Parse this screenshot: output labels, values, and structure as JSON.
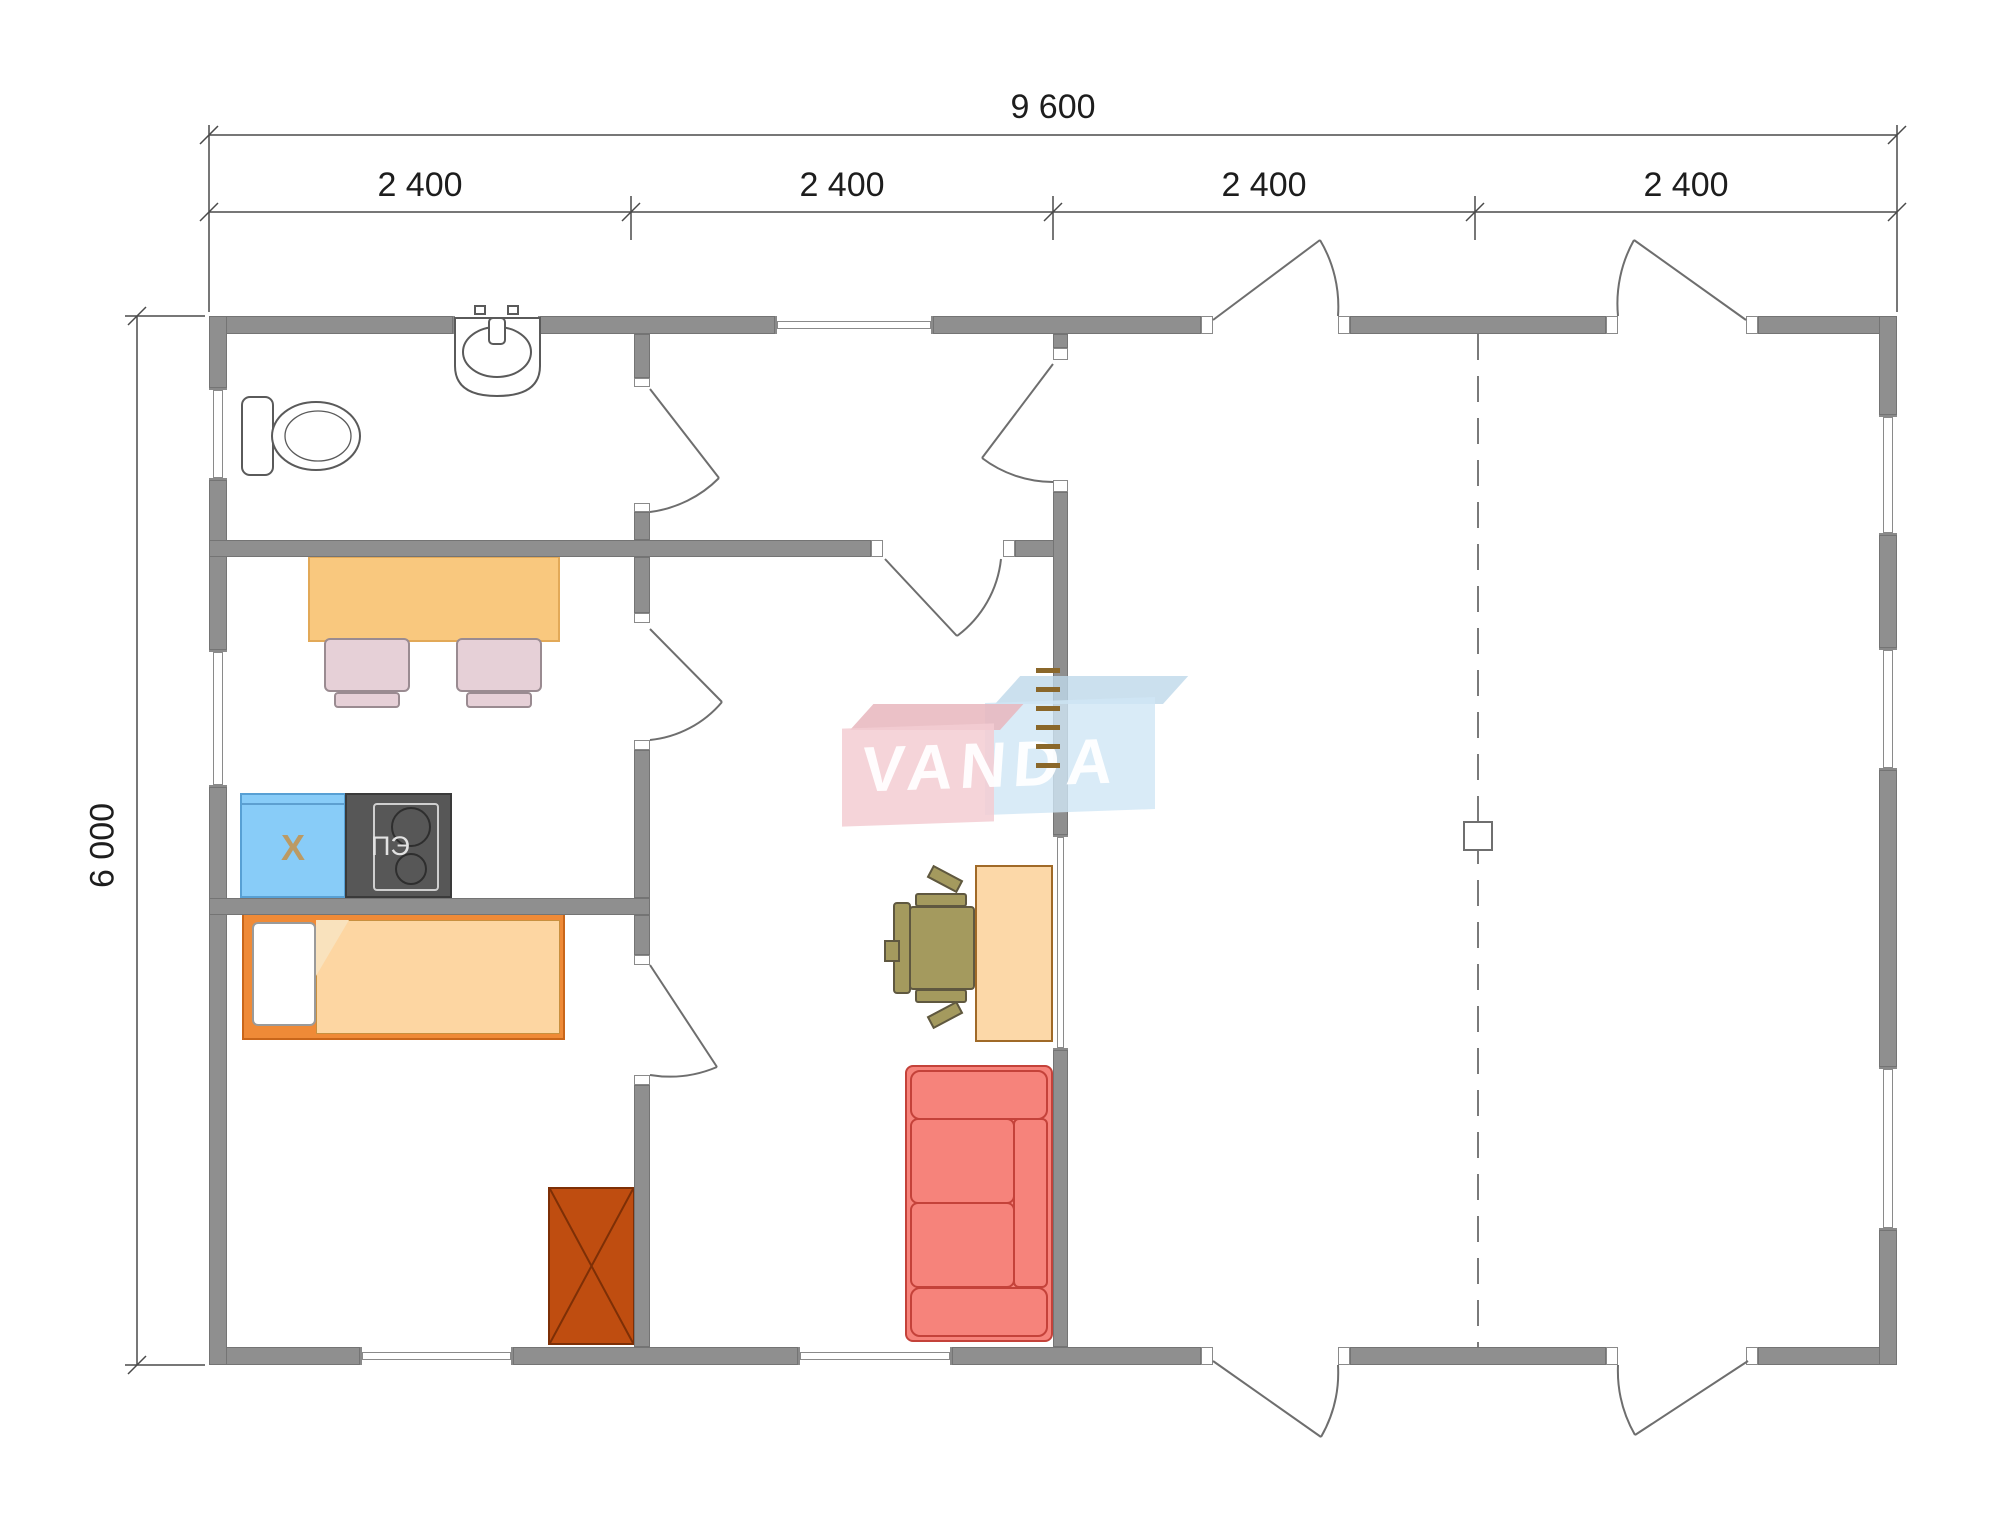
{
  "dimension_labels": {
    "overall_width": "9 600",
    "overall_height": "6 000",
    "modules": [
      "2 400",
      "2 400",
      "2 400",
      "2 400"
    ]
  },
  "appliance_labels": {
    "refrigerator": "X",
    "electric_stove": "ПЭ"
  },
  "watermark": {
    "text": "VANDA",
    "pink_color": "#f3cdd2",
    "blue_color": "#cfe6f5"
  },
  "colors": {
    "wall": "#8f8f8f",
    "dining_table": "#f9c87e",
    "kitchen_chair": "#e6d0d7",
    "refrigerator": "#88ccf8",
    "stove": "#575757",
    "bed_frame": "#ef8a37",
    "blanket": "#fdd6a2",
    "wardrobe": "#bf4d10",
    "desk": "#fcd8a8",
    "office_chair": "#a49a5e",
    "sofa": "#f6837b",
    "ladder": "#8a672a"
  },
  "fixtures": [
    "toilet",
    "sink",
    "dining-table",
    "kitchen-chairs",
    "refrigerator",
    "electric-stove",
    "single-bed",
    "wardrobe",
    "desk",
    "office-chair",
    "sofa",
    "ladder",
    "column",
    "entry-doors"
  ]
}
